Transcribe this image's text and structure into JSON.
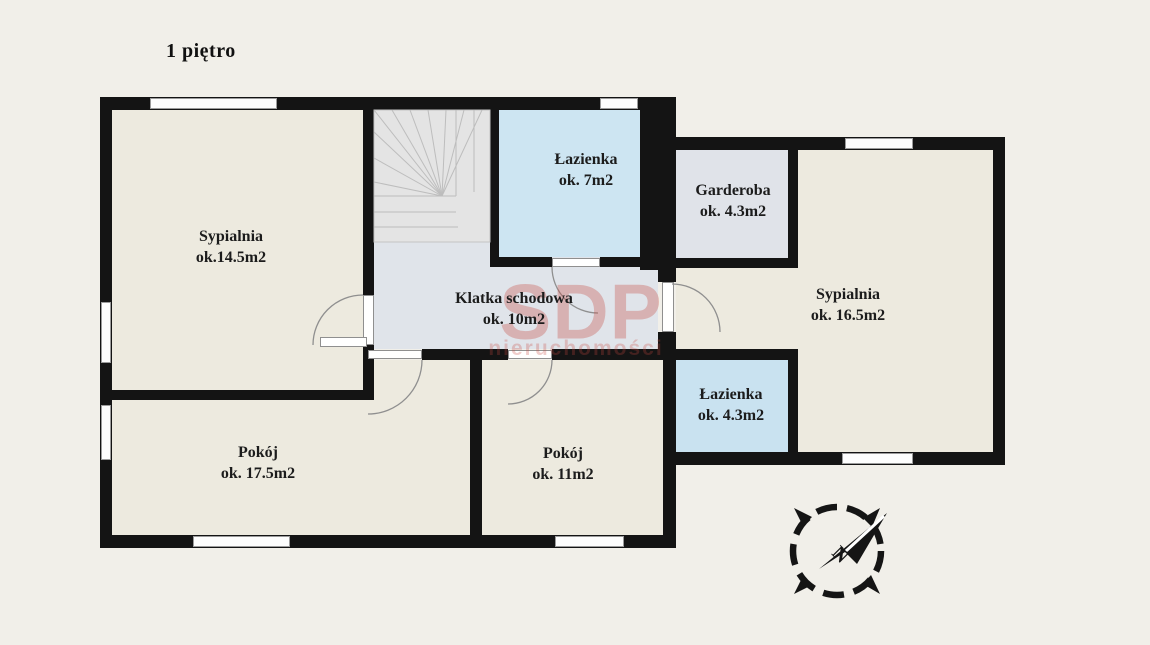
{
  "title": "1 piętro",
  "rooms": [
    {
      "id": "sypialnia-1",
      "name": "Sypialnia",
      "area": "ok.14.5m2"
    },
    {
      "id": "lazienka-1",
      "name": "Łazienka",
      "area": "ok. 7m2"
    },
    {
      "id": "garderoba",
      "name": "Garderoba",
      "area": "ok. 4.3m2"
    },
    {
      "id": "sypialnia-2",
      "name": "Sypialnia",
      "area": "ok. 16.5m2"
    },
    {
      "id": "klatka-schodowa",
      "name": "Klatka schodowa",
      "area": "ok. 10m2"
    },
    {
      "id": "lazienka-2",
      "name": "Łazienka",
      "area": "ok. 4.3m2"
    },
    {
      "id": "pokoj-1",
      "name": "Pokój",
      "area": "ok. 17.5m2"
    },
    {
      "id": "pokoj-2",
      "name": "Pokój",
      "area": "ok. 11m2"
    }
  ],
  "watermark": {
    "line1": "SDP",
    "line2": "nieruchomości"
  },
  "compass": {
    "label": "N"
  },
  "colors": {
    "background": "#f1efe9",
    "wall": "#141414",
    "room_cream": "#edeadf",
    "hall_gray": "#e0e4ea",
    "bath_blue": "#cde5f2",
    "bath_blue_2": "#c9e2f0",
    "wardrobe_gray": "#e0e3e9",
    "stairs_gray": "#e4e4e4",
    "watermark_red": "#c64840",
    "window_frame": "#9b9b9b",
    "label_text": "#1c1c1c"
  }
}
